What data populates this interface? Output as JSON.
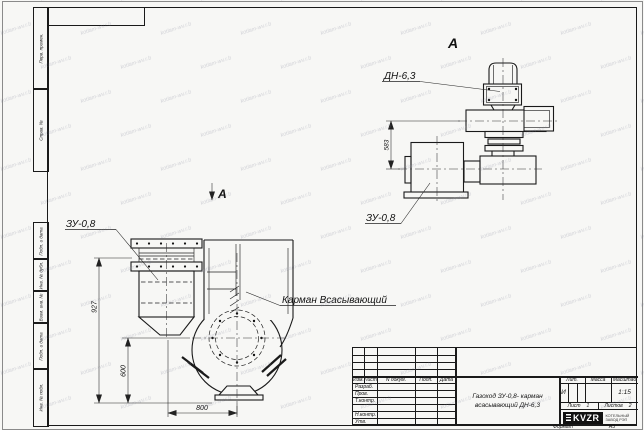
{
  "frame": {
    "left_columns": {
      "perv_primen": "Перв. примен.",
      "sprav_no": "Справ. №",
      "podp_data_1": "Подп. и дата",
      "inv_dubl": "Инв. № дубл.",
      "vzam_inv": "Взам. инв. №",
      "podp_data_2": "Подп. и дата",
      "inv_podl": "Инв. № подл."
    },
    "format_label": "Формат",
    "format_value": "А3"
  },
  "title_block": {
    "header_cols": [
      "Изм.",
      "Лист",
      "N докум.",
      "Подп.",
      "Дата"
    ],
    "role_rows": [
      "Разраб.",
      "Пров.",
      "Т.контр.",
      "Н.контр.",
      "Утв."
    ],
    "title_line1": "Газоход ЗУ-0,8- карман",
    "title_line2": "всасывающий ДН-6,3",
    "lit_header": "Лит.",
    "mass_header": "Масса",
    "scale_header": "Масштаб",
    "lit_value": "И",
    "scale_value": "1:15",
    "sheet_label": "Лист",
    "sheet_value": "1",
    "sheets_label": "Листов",
    "sheets_value": "2",
    "company_logo": "KVZR",
    "company_line1": "КОТЕЛЬНЫЙ",
    "company_line2": "ЗАВОД РЭП"
  },
  "drawing": {
    "view_letter": "А",
    "labels": {
      "zu_front": "ЗУ-0,8",
      "zu_side": "ЗУ-0,8",
      "dn": "ДН-6,3",
      "pocket": "Карман Всасывающий"
    },
    "dimensions": {
      "d927": "927",
      "d600": "600",
      "d800": "800",
      "d583": "583"
    }
  },
  "watermark": {
    "text": "kotlam-wv.r.b"
  },
  "colors": {
    "line": "#1a1a1a",
    "paper": "#f7f7f5",
    "watermark": "rgba(125,130,150,0.30)"
  }
}
